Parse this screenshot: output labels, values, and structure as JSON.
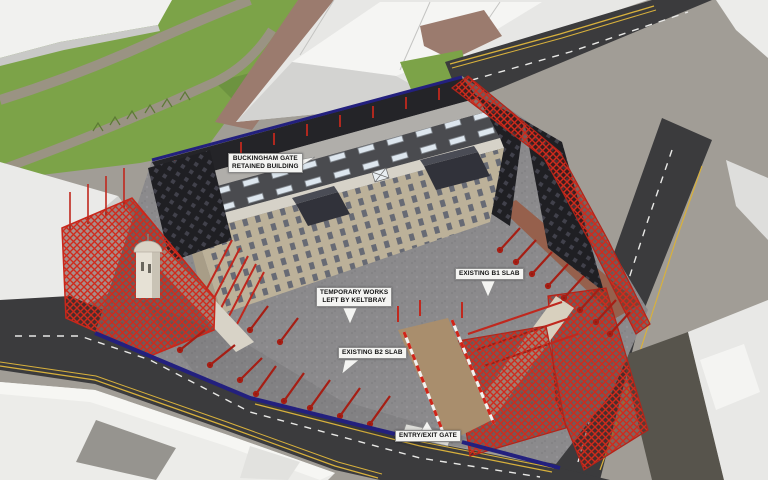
{
  "annotations": [
    {
      "id": "buckingham-gate-retained-building",
      "line1": "BUCKINGHAM GATE",
      "line2": "RETAINED BUILDING"
    },
    {
      "id": "temporary-works-left-by-keltbray",
      "line1": "TEMPORARY WORKS",
      "line2": "LEFT BY KELTBRAY"
    },
    {
      "id": "existing-b1-slab",
      "line1": "EXISTING B1 SLAB"
    },
    {
      "id": "existing-b2-slab",
      "line1": "EXISTING B2 SLAB"
    },
    {
      "id": "entry-exit-gate",
      "line1": "ENTRY/EXIT GATE"
    }
  ],
  "palette": {
    "temporary_works_red": "#c8271b",
    "temporary_works_red_dark": "#a61e14",
    "hoarding_blue": "#23207e",
    "park_green": "#7ca348",
    "tree_green": "#6d9340",
    "red_tarmac": "#9b7b6e",
    "asphalt": "#3b3b3d",
    "concrete_slab": "#8a898b",
    "retained_building_beige": "#bcb199",
    "brick_base": "#96604c",
    "massing_white": "#ececea",
    "label_bg": "#f4f4f2"
  }
}
